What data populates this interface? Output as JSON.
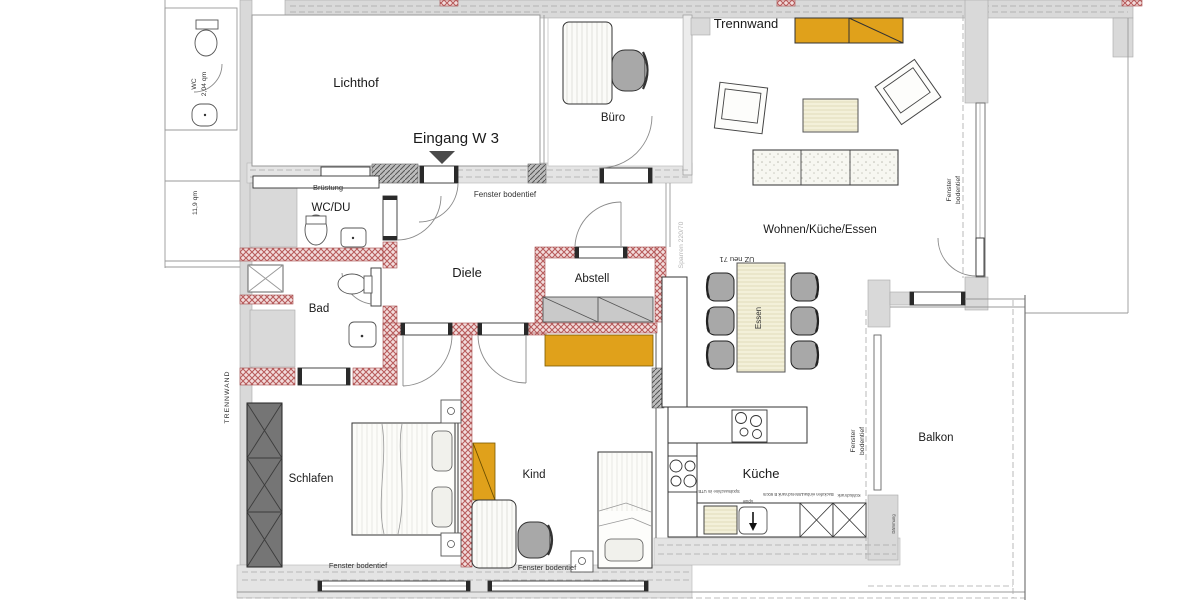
{
  "plan": {
    "rooms": {
      "lichthof": "Lichthof",
      "buero": "Büro",
      "wcdu": "WC/DU",
      "bad": "Bad",
      "diele": "Diele",
      "abstell": "Abstell",
      "wohnen": "Wohnen/Küche/Essen",
      "schlafen": "Schlafen",
      "kind": "Kind",
      "kueche": "Küche",
      "balkon": "Balkon"
    },
    "annotations": {
      "eingang": "Eingang W 3",
      "trennwand": "Trennwand",
      "trennwand_vertical": "TRENNWAND",
      "bruestung": "Brüstung",
      "fenster_bodentief": "Fenster bodentief",
      "fenster": "Fenster",
      "bodentief": "bodentief",
      "wc": "WC",
      "wc_area": "2,04 qm",
      "area_11_9": "11,9 qm",
      "essen": "Essen",
      "uz_neu": "UZ neu 71",
      "sparren": "Sparren 220/70",
      "daemmung": "Dämmung"
    },
    "kitchen_labels": {
      "spuelmaschine": "Spülmaschine im UTB",
      "spuele": "Spüle",
      "unterschrank": "Unterschrank B 60cm",
      "backofen": "Backofen einbau",
      "kuehlschrank": "Kühlschrank"
    },
    "colors": {
      "new_wall_red": "#b85c5c",
      "accent_orange": "#e0a11b",
      "existing_wall": "#d9d9d9",
      "wardrobe_dark": "#757575",
      "chair_gray": "#a8a8a8",
      "cream": "#f3f0d9"
    }
  }
}
